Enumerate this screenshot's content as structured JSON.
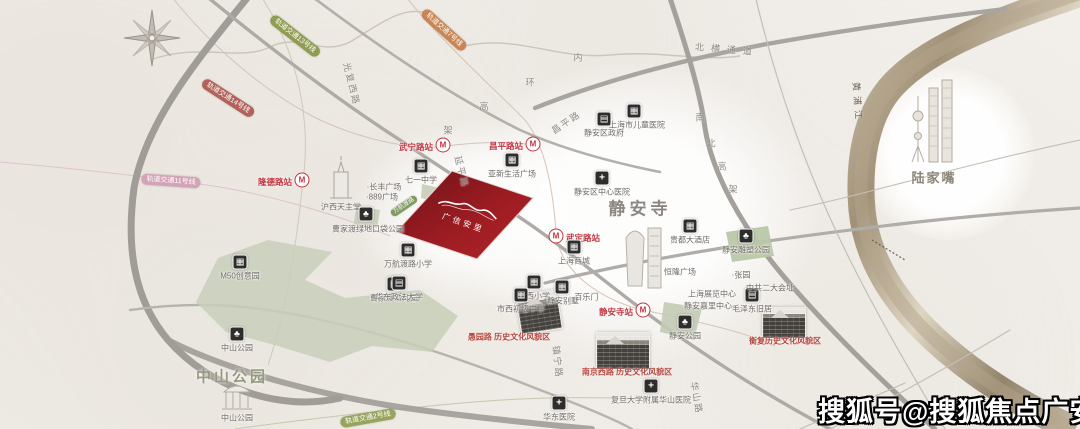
{
  "watermark": {
    "text": "搜狐号@搜狐焦点广安站"
  },
  "map": {
    "parcel": {
      "name": "广信安里",
      "fill_dark": "#6f1318",
      "fill_light": "#b2252b"
    },
    "big_labels": [
      {
        "text": "静安寺",
        "x": 640,
        "y": 207,
        "size": 17,
        "color": "#8c8780",
        "ls": 4
      },
      {
        "text": "中山公园",
        "x": 232,
        "y": 376,
        "size": 15,
        "color": "#969a80",
        "ls": 3
      },
      {
        "text": "陆家嘴",
        "x": 934,
        "y": 177,
        "size": 13,
        "color": "#8b8478",
        "ls": 2
      }
    ],
    "stations": [
      {
        "name": "隆德路站",
        "x": 302,
        "y": 180,
        "side": "left"
      },
      {
        "name": "武宁路站",
        "x": 443,
        "y": 145,
        "side": "left"
      },
      {
        "name": "昌平路站",
        "x": 533,
        "y": 144,
        "side": "left"
      },
      {
        "name": "武定路站",
        "x": 556,
        "y": 236,
        "side": "right"
      },
      {
        "name": "静安寺站",
        "x": 643,
        "y": 310,
        "side": "left"
      }
    ],
    "metro_icon_letter": "M",
    "line_badges": [
      {
        "text": "轨道交通13号线",
        "x": 295,
        "y": 36,
        "rot": 38,
        "color": "#8f9c52"
      },
      {
        "text": "轨道交通7号线",
        "x": 444,
        "y": 30,
        "rot": 42,
        "color": "#c98553"
      },
      {
        "text": "轨道交通14号线",
        "x": 228,
        "y": 98,
        "rot": 33,
        "color": "#b2625a"
      },
      {
        "text": "轨道交通11号线",
        "x": 171,
        "y": 181,
        "rot": 4,
        "color": "#d3a3b8"
      },
      {
        "text": "轨道交通2号线",
        "x": 368,
        "y": 418,
        "rot": -10,
        "color": "#97a45e"
      },
      {
        "text": "万航渡路",
        "x": 404,
        "y": 206,
        "rot": -34,
        "color": "#7f9a62",
        "small": true
      }
    ],
    "pois": [
      {
        "icon": "building",
        "ix": 240,
        "iy": 262,
        "label": "M50创意园",
        "lx": 240,
        "ly": 276
      },
      {
        "icon": "none",
        "label": "沪西天主堂",
        "lx": 341,
        "ly": 207
      },
      {
        "icon": "tree",
        "ix": 366,
        "iy": 214,
        "label": "曹家渡绿地口袋公园",
        "lx": 368,
        "ly": 229
      },
      {
        "icon": "building",
        "ix": 421,
        "iy": 166,
        "label": "七一中学",
        "lx": 421,
        "ly": 180
      },
      {
        "icon": "none",
        "label": "·长丰广场",
        "lx": 384,
        "ly": 187
      },
      {
        "icon": "none",
        "label": "·889广场",
        "lx": 382,
        "ly": 197
      },
      {
        "icon": "building",
        "ix": 408,
        "iy": 250,
        "label": "万航渡路小学",
        "lx": 408,
        "ly": 264
      },
      {
        "icon": "building",
        "ix": 394,
        "iy": 284,
        "label": "曹家渡幼儿园",
        "lx": 394,
        "ly": 298
      },
      {
        "icon": "building",
        "ix": 512,
        "iy": 160,
        "label": "亚新生活广场",
        "lx": 512,
        "ly": 174
      },
      {
        "icon": "bank",
        "ix": 604,
        "iy": 119,
        "label": "静安区政府",
        "lx": 604,
        "ly": 133
      },
      {
        "icon": "building",
        "ix": 634,
        "iy": 111,
        "label": "上海市儿童医院",
        "lx": 637,
        "ly": 125
      },
      {
        "icon": "hospital",
        "ix": 602,
        "iy": 178,
        "label": "静安区中心医院",
        "lx": 602,
        "ly": 192
      },
      {
        "icon": "building",
        "ix": 574,
        "iy": 247,
        "label": "上海商城",
        "lx": 574,
        "ly": 261
      },
      {
        "icon": "building",
        "ix": 690,
        "iy": 226,
        "label": "贵都大酒店",
        "lx": 690,
        "ly": 240
      },
      {
        "icon": "none",
        "label": "恒隆广场",
        "lx": 680,
        "ly": 272
      },
      {
        "icon": "none",
        "label": "上海展览中心",
        "lx": 712,
        "ly": 294
      },
      {
        "icon": "none",
        "label": "静安嘉里中心",
        "lx": 708,
        "ly": 306
      },
      {
        "icon": "bank",
        "ix": 752,
        "iy": 295,
        "label": "毛泽东旧居",
        "lx": 752,
        "ly": 309
      },
      {
        "icon": "none",
        "label": "·张园",
        "lx": 741,
        "ly": 275
      },
      {
        "icon": "none",
        "label": "中共二大会址",
        "lx": 770,
        "ly": 288
      },
      {
        "icon": "tree",
        "ix": 746,
        "iy": 236,
        "label": "静安雕塑公园",
        "lx": 746,
        "ly": 250
      },
      {
        "icon": "none",
        "label": "·百乐门",
        "lx": 585,
        "ly": 297
      },
      {
        "icon": "building",
        "ix": 534,
        "iy": 282,
        "label": "市西小学",
        "lx": 534,
        "ly": 296
      },
      {
        "icon": "building",
        "ix": 562,
        "iy": 287,
        "label": "静安别墅",
        "lx": 563,
        "ly": 301
      },
      {
        "icon": "building",
        "ix": 521,
        "iy": 295,
        "label": "市西初级中学",
        "lx": 521,
        "ly": 309
      },
      {
        "icon": "tree",
        "ix": 685,
        "iy": 322,
        "label": "静安公园",
        "lx": 685,
        "ly": 336
      },
      {
        "icon": "hospital",
        "ix": 559,
        "iy": 403,
        "label": "华东医院",
        "lx": 559,
        "ly": 417
      },
      {
        "icon": "hospital",
        "ix": 651,
        "iy": 386,
        "label": "复旦大学附属华山医院",
        "lx": 651,
        "ly": 400
      },
      {
        "icon": "bank",
        "ix": 399,
        "iy": 283,
        "label": "华东政法大学",
        "lx": 399,
        "ly": 297
      },
      {
        "icon": "tree",
        "ix": 237,
        "iy": 334,
        "label": "中山公园",
        "lx": 237,
        "ly": 348
      },
      {
        "icon": "none",
        "label": "中山公园",
        "lx": 237,
        "ly": 418
      }
    ],
    "road_labels": [
      {
        "text": "内",
        "x": 578,
        "y": 57
      },
      {
        "text": "环",
        "x": 530,
        "y": 82
      },
      {
        "text": "高",
        "x": 484,
        "y": 106
      },
      {
        "text": "架",
        "x": 448,
        "y": 130
      },
      {
        "text": "南",
        "x": 700,
        "y": 117
      },
      {
        "text": "北",
        "x": 711,
        "y": 143
      },
      {
        "text": "高",
        "x": 722,
        "y": 166
      },
      {
        "text": "架",
        "x": 733,
        "y": 189
      },
      {
        "text": "北横通道",
        "x": 727,
        "y": 49,
        "rot": 5,
        "ls": 7
      },
      {
        "text": "光复西路",
        "x": 352,
        "y": 84,
        "rot": 76,
        "ls": 2
      },
      {
        "text": "延平路",
        "x": 462,
        "y": 172,
        "rot": 76,
        "ls": 2
      },
      {
        "text": "昌平路",
        "x": 566,
        "y": 122,
        "rot": -34,
        "ls": 2
      },
      {
        "text": "镇宁路",
        "x": 558,
        "y": 362,
        "rot": 84,
        "ls": 2
      },
      {
        "text": "华山路",
        "x": 697,
        "y": 398,
        "rot": 80,
        "ls": 2
      },
      {
        "text": "黄浦江",
        "x": 858,
        "y": 103,
        "rot": 86,
        "ls": 5,
        "color": "#6b5f4e"
      }
    ],
    "area_labels": [
      {
        "text": "愚园路 历史文化风貌区",
        "x": 509,
        "y": 337
      },
      {
        "text": "南京西路 历史文化风貌区",
        "x": 627,
        "y": 372
      },
      {
        "text": "衡复历史文化风貌区",
        "x": 785,
        "y": 341
      }
    ]
  }
}
